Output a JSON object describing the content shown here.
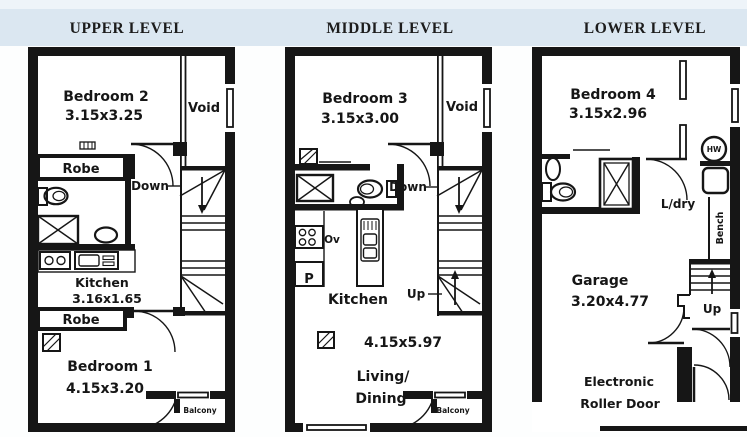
{
  "page": {
    "background": "#fdfefe",
    "band_color": "#dbe7f1",
    "band_top_color": "#eef4f9",
    "ink_color": "#161616"
  },
  "levels": {
    "upper": {
      "title": "UPPER LEVEL",
      "bedroom2_name": "Bedroom 2",
      "bedroom2_dims": "3.15x3.25",
      "void_label": "Void",
      "robe_top_label": "Robe",
      "down_label": "Down",
      "kitchen_name": "Kitchen",
      "kitchen_dims": "3.16x1.65",
      "robe_bottom_label": "Robe",
      "bedroom1_name": "Bedroom 1",
      "bedroom1_dims": "4.15x3.20",
      "balcony_label": "Balcony"
    },
    "middle": {
      "title": "MIDDLE LEVEL",
      "bedroom3_name": "Bedroom 3",
      "bedroom3_dims": "3.15x3.00",
      "void_label": "Void",
      "down_label": "Down",
      "oven_label": "Ov",
      "pantry_label": "P",
      "kitchen_name": "Kitchen",
      "up_label": "Up",
      "living_dims": "4.15x5.97",
      "living_line1": "Living/",
      "living_line2": "Dining",
      "balcony_label": "Balcony"
    },
    "lower": {
      "title": "LOWER LEVEL",
      "bedroom4_name": "Bedroom 4",
      "bedroom4_dims": "3.15x2.96",
      "hw_label": "HW",
      "laundry_label": "L/dry",
      "bench_label": "Bench",
      "garage_name": "Garage",
      "garage_dims": "3.20x4.77",
      "up_label": "Up",
      "roller_line1": "Electronic",
      "roller_line2": "Roller Door"
    }
  }
}
